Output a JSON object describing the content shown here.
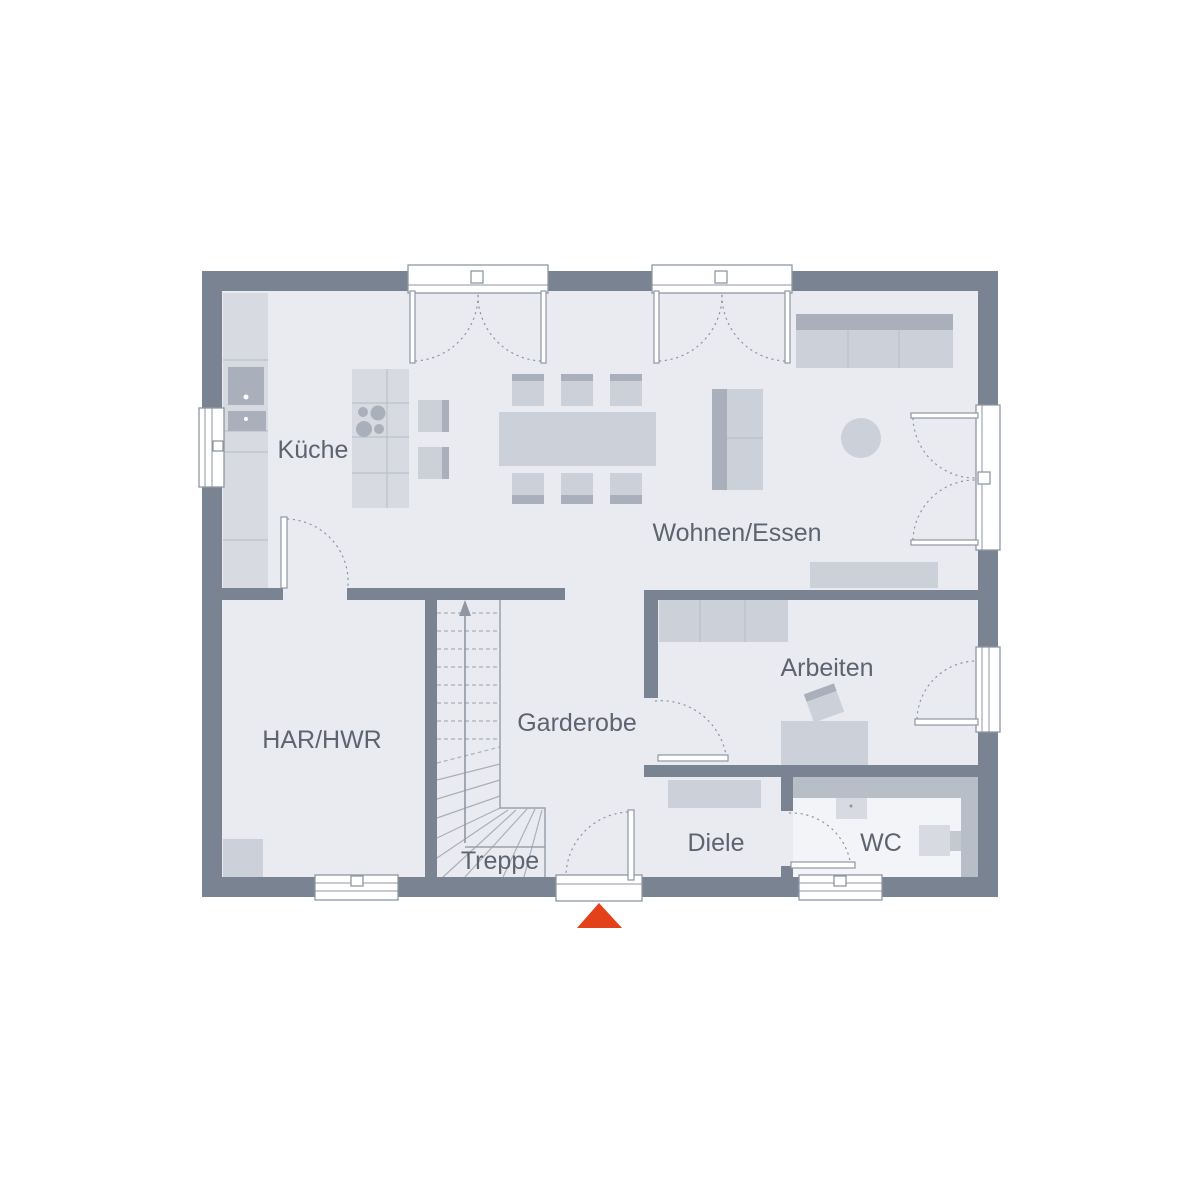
{
  "floorplan": {
    "rooms": [
      {
        "id": "kueche",
        "label": "Küche"
      },
      {
        "id": "wohnen_essen",
        "label": "Wohnen/Essen"
      },
      {
        "id": "arbeiten",
        "label": "Arbeiten"
      },
      {
        "id": "garderobe",
        "label": "Garderobe"
      },
      {
        "id": "har_hwr",
        "label": "HAR/HWR"
      },
      {
        "id": "treppe",
        "label": "Treppe"
      },
      {
        "id": "diele",
        "label": "Diele"
      },
      {
        "id": "wc",
        "label": "WC"
      }
    ],
    "colors": {
      "wall": "#7a8391",
      "floor": "#e9ebf0",
      "furniture_light": "#d7dae0",
      "furniture": "#ccd0d8",
      "furniture_dark": "#a9b0bb",
      "wc_tile_band": "#b8bec8",
      "wc_floor": "#f3f4f7",
      "line": "#8f97a3",
      "label_text": "#5d6470",
      "entrance_marker": "#e2411a"
    },
    "entrance_marker": {
      "shape": "triangle-up"
    }
  }
}
